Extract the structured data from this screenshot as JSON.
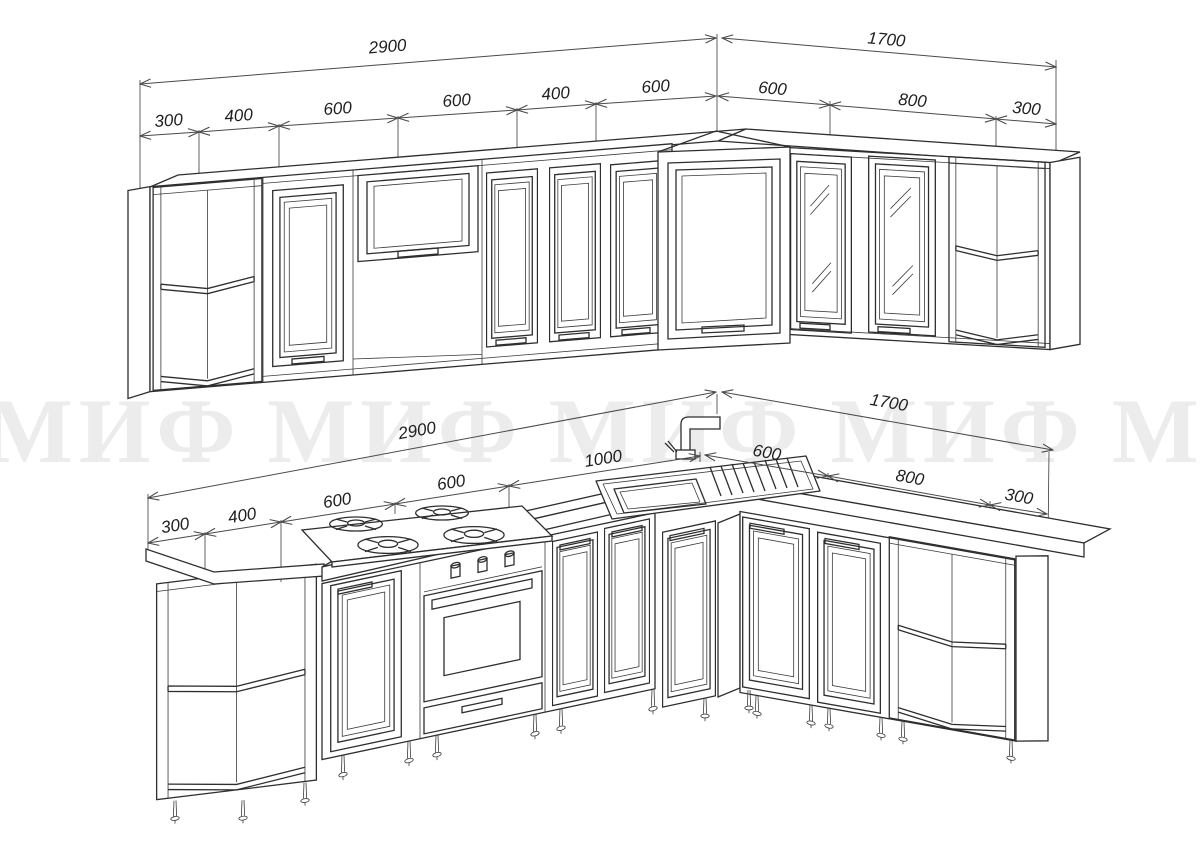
{
  "watermark": {
    "text": "МИФ",
    "repeats": 6
  },
  "top_view": {
    "description": "wall-cabinets-isometric-view",
    "overall_left": "2900",
    "overall_right": "1700",
    "segments_left": [
      "300",
      "400",
      "600",
      "600",
      "400",
      "600"
    ],
    "segments_right": [
      "600",
      "800",
      "300"
    ]
  },
  "bottom_view": {
    "description": "base-cabinets-isometric-view",
    "overall_left": "2900",
    "overall_right": "1700",
    "segments_left": [
      "300",
      "400",
      "600",
      "600",
      "1000"
    ],
    "segments_right": [
      "600",
      "800",
      "300"
    ]
  }
}
